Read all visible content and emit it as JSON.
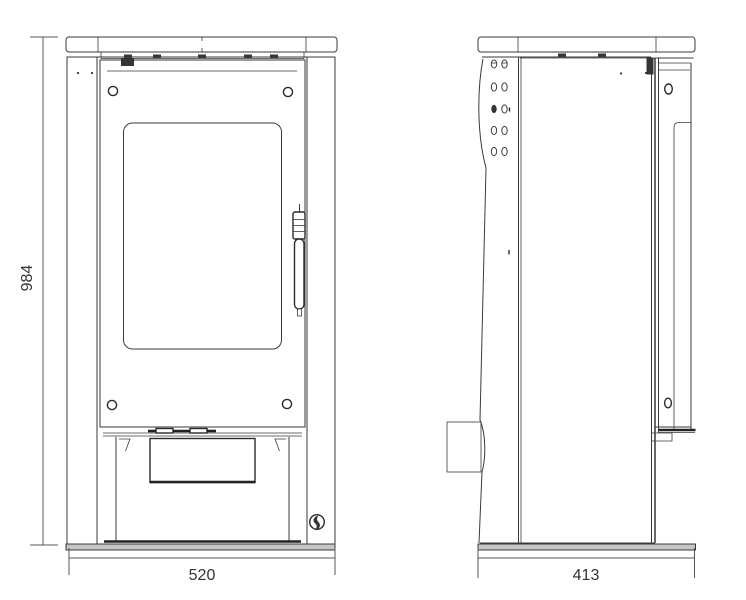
{
  "diagram": {
    "kind": "stove-technical-drawing-front-and-side-views",
    "background": "#ffffff",
    "line_color": "#3a3a3a",
    "dimensions": {
      "height": "984",
      "width": "520",
      "depth": "413"
    },
    "icons": {
      "brand_logo": "flame-circle-logo-icon"
    }
  }
}
